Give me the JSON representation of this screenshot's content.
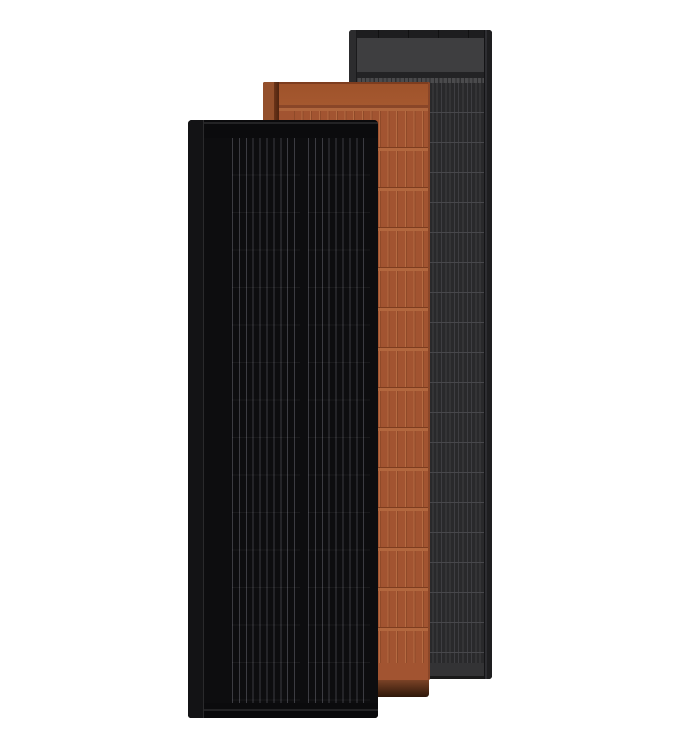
{
  "meta": {
    "description": "Product render of three overlapping vertical solar roof panels on a white background",
    "panel_count": 3
  },
  "panels": [
    {
      "key": "charcoal",
      "name": "Charcoal grey solar panel",
      "position": "rear right",
      "texture": "fine vertical cell stripes with horizontal row seams, grey header band at top",
      "primary_color": "#3e3e40"
    },
    {
      "key": "terracotta",
      "name": "Terracotta solar roof tile panel",
      "position": "middle",
      "texture": "vertical tile strips in rows of ~40px with lighter groove lines, solid header band, dark under-tile shadow at bottom",
      "primary_color": "#a25431"
    },
    {
      "key": "black",
      "name": "Matte black solar panel",
      "position": "front left",
      "texture": "two columns of fine vertical busbar lines separated by a center gap, black frame",
      "primary_color": "#0d0d0f"
    }
  ],
  "colors": {
    "page_bg": "#ffffff",
    "charcoal_frame_top": "#1d1d1f",
    "charcoal_header": "#3e3e40",
    "charcoal_dark_band": "#232325",
    "charcoal_tick_light": "#4b4b4d",
    "charcoal_tick_dark": "#2e2e30",
    "charcoal_cell_bg": "#29292b",
    "charcoal_cell_line": "#3e3e42",
    "charcoal_row_line": "#47474b",
    "charcoal_left_frame": "#2c2c2e",
    "charcoal_right_frame": "#1e1e20",
    "charcoal_footer": "#333335",
    "charcoal_bottom_edge": "#191919",
    "terracotta_top_edge": "#7e3d1f",
    "terracotta_header": "#a5582f",
    "terracotta_divider": "#8a4628",
    "terracotta_subband": "#b0663d",
    "terracotta_cell_bg": "#a25431",
    "terracotta_cell_line_light": "#b66b42",
    "terracotta_cell_line_dark": "#8f4a29",
    "terracotta_row_dark": "#7e3d1f",
    "terracotta_row_light": "#b2673e",
    "terracotta_left_strip": "#94502c",
    "terracotta_ridge": "#4f2410",
    "terracotta_footer": "#a25431",
    "terracotta_shadow_top": "#7a4226",
    "terracotta_shadow_bottom": "#2e1709",
    "black_frame": "#0b0b0d",
    "black_face": "#0d0d0f",
    "black_side_strip": "#131315",
    "black_side_line": "#2a2a2c",
    "black_cell_line": "#3c3c42",
    "black_row_line": "rgba(255,255,255,0.05)",
    "black_highlight": "#232325"
  }
}
